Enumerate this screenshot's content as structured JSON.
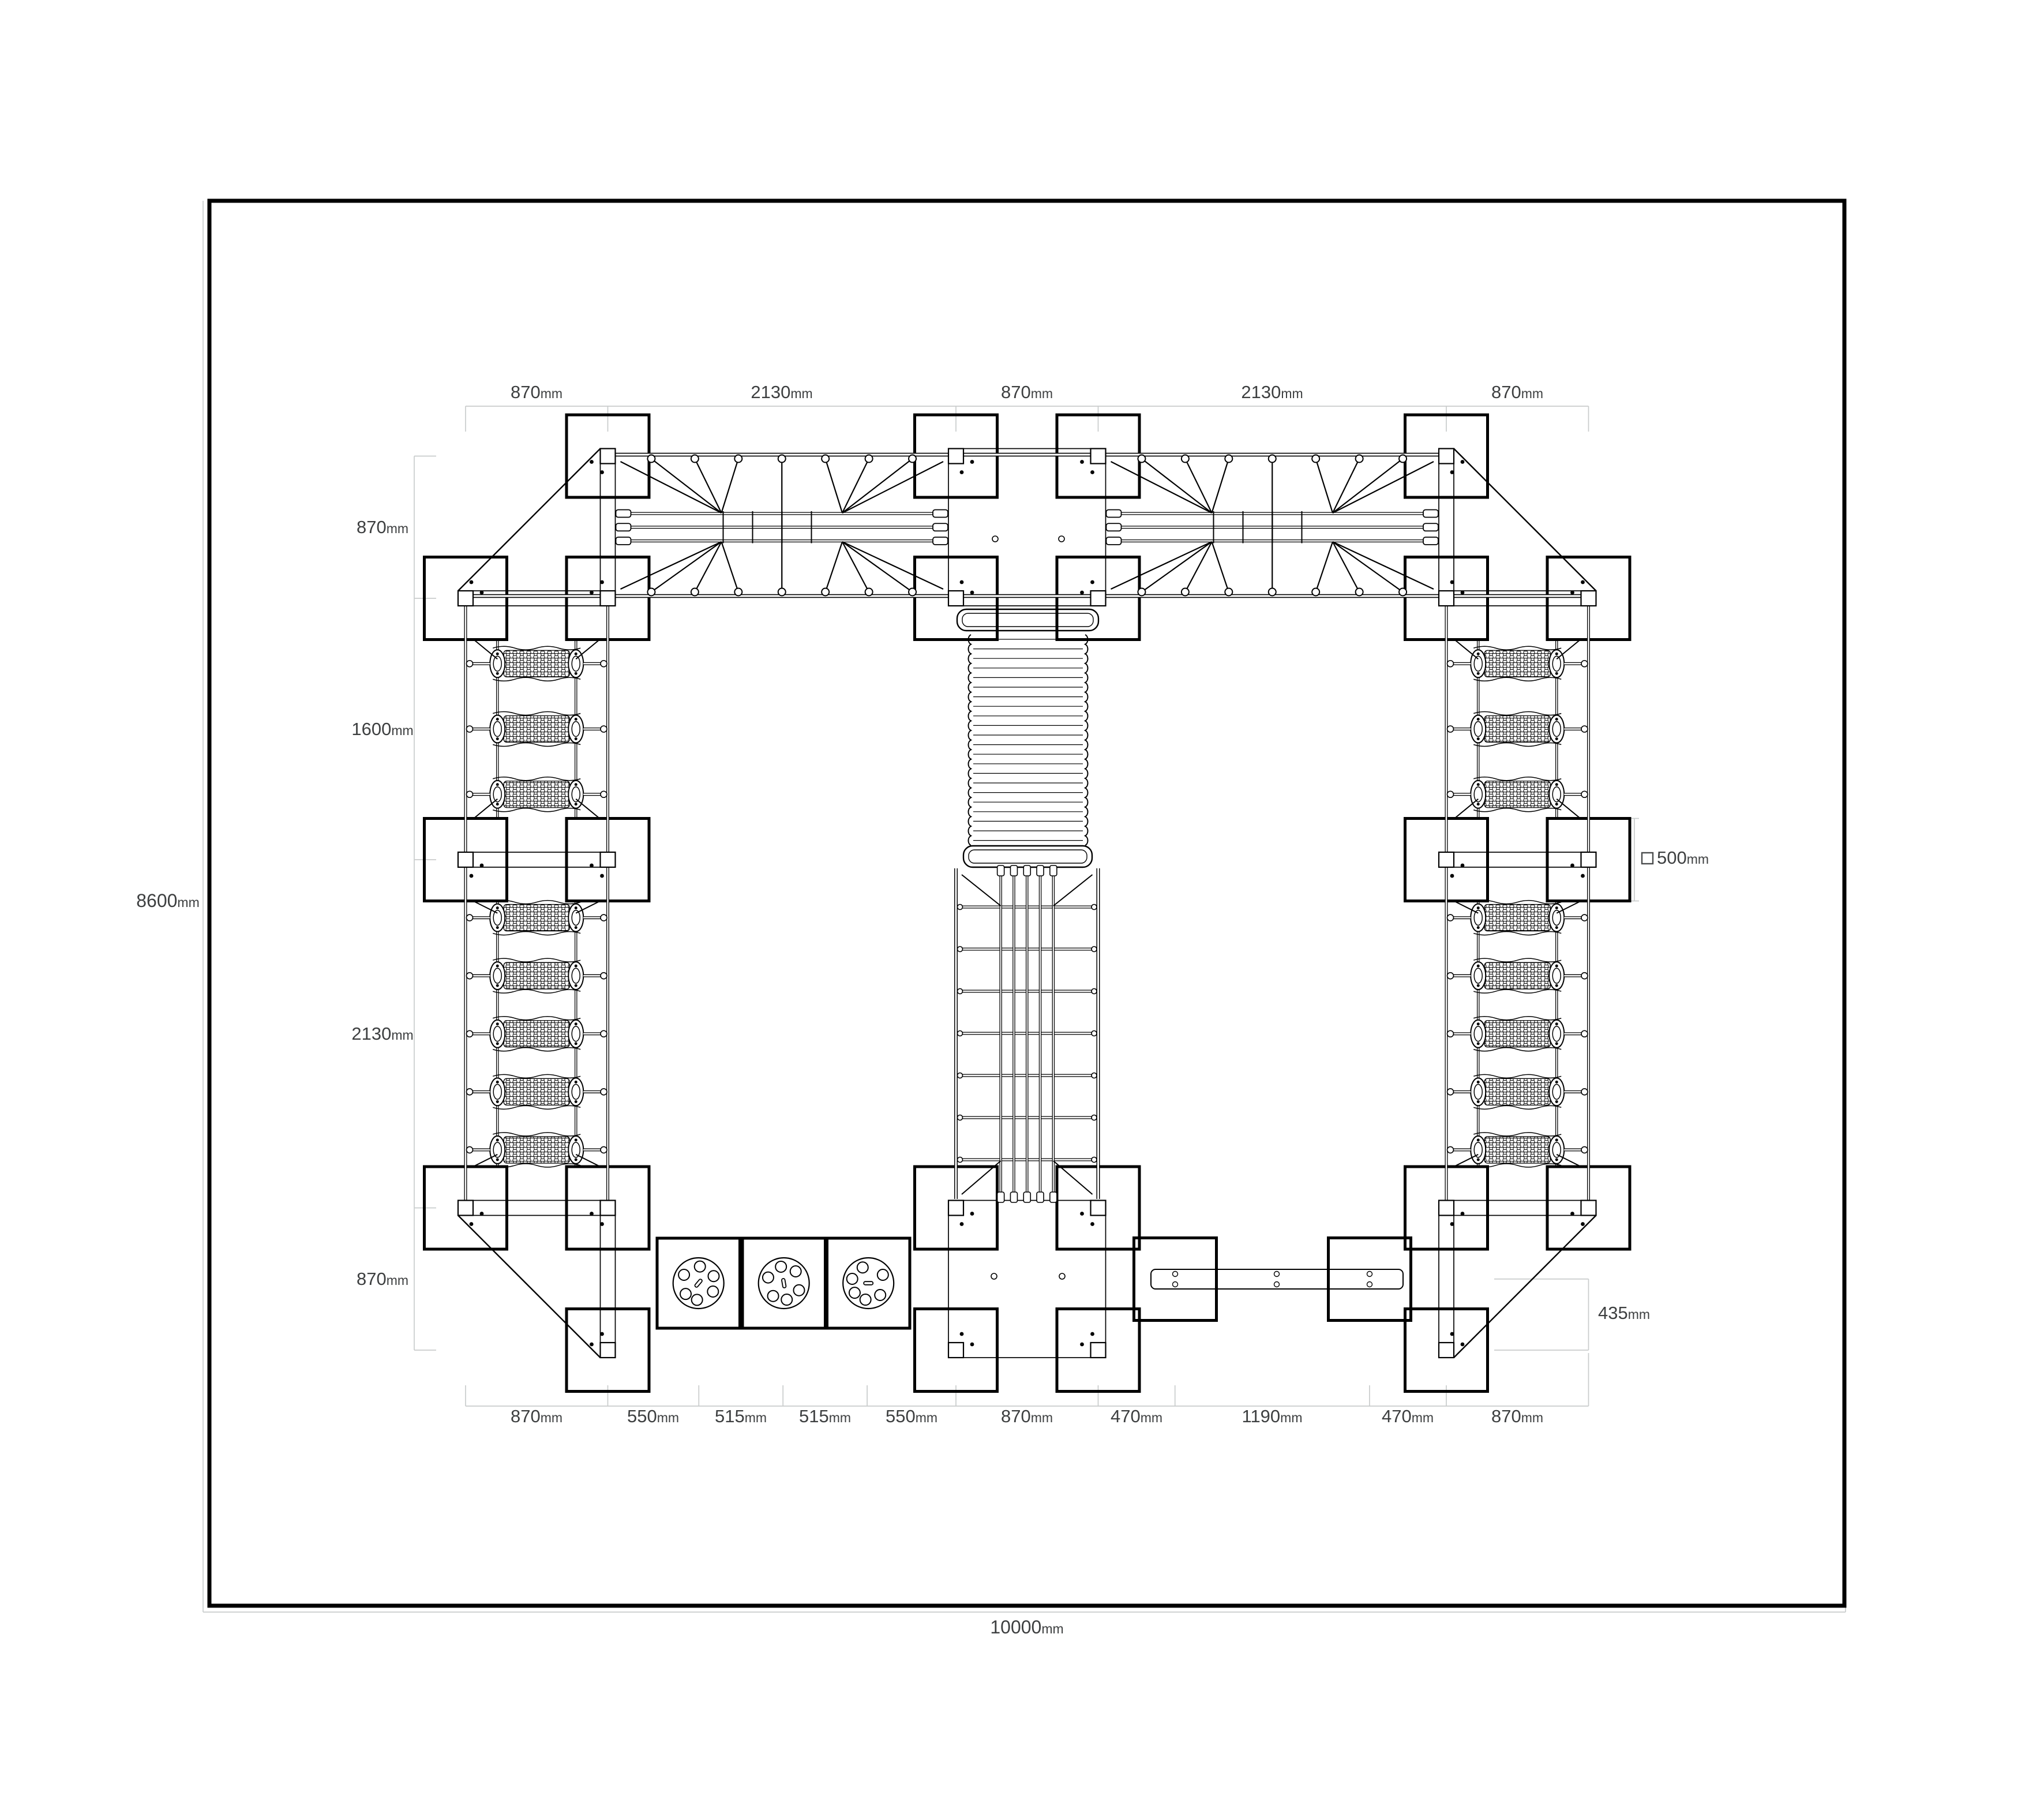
{
  "page": {
    "type": "playground-equipment-plan-drawing",
    "background": "#ffffff"
  },
  "colors": {
    "line": "#000000",
    "dim_line": "#c9cccc",
    "dim_text": "#3d3f40"
  },
  "dimensions": {
    "top": [
      {
        "value": "870",
        "unit": "mm"
      },
      {
        "value": "2130",
        "unit": "mm"
      },
      {
        "value": "870",
        "unit": "mm"
      },
      {
        "value": "2130",
        "unit": "mm"
      },
      {
        "value": "870",
        "unit": "mm"
      }
    ],
    "left": [
      {
        "value": "870",
        "unit": "mm"
      },
      {
        "value": "1600",
        "unit": "mm"
      },
      {
        "value": "2130",
        "unit": "mm"
      },
      {
        "value": "870",
        "unit": "mm"
      }
    ],
    "bottom": [
      {
        "value": "870",
        "unit": "mm"
      },
      {
        "value": "550",
        "unit": "mm"
      },
      {
        "value": "515",
        "unit": "mm"
      },
      {
        "value": "515",
        "unit": "mm"
      },
      {
        "value": "550",
        "unit": "mm"
      },
      {
        "value": "870",
        "unit": "mm"
      },
      {
        "value": "470",
        "unit": "mm"
      },
      {
        "value": "1190",
        "unit": "mm"
      },
      {
        "value": "470",
        "unit": "mm"
      },
      {
        "value": "870",
        "unit": "mm"
      }
    ],
    "right": [
      {
        "value": "435",
        "unit": "mm"
      }
    ],
    "overall_width": {
      "value": "10000",
      "unit": "mm"
    },
    "overall_height": {
      "value": "8600",
      "unit": "mm"
    },
    "legend_post_size": {
      "value": "500",
      "unit": "mm"
    }
  }
}
